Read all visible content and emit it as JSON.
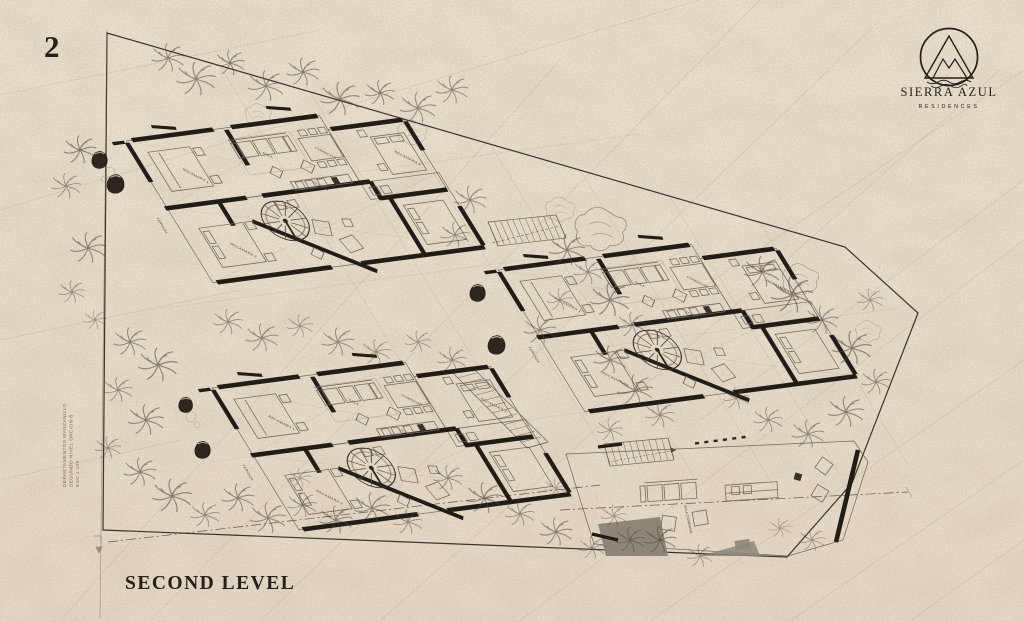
{
  "sheet": {
    "number": "2",
    "level_title": "SECOND LEVEL"
  },
  "logo": {
    "name": "SIERRA AZUL",
    "subtitle": "RESIDENCES"
  },
  "margin_note": {
    "line1": "DEPARTAMENTOS MANZANILLO",
    "line2": "SEGUNDO NIVEL OPCION B",
    "line3": "ESC 1:100"
  },
  "plan": {
    "room_labels": {
      "bedroom1": "RECAMARA 1",
      "bedroom2": "RECAMARA 2",
      "bedroom3": "RECAMARA 3",
      "living": "SALA",
      "dining": "COMEDOR",
      "kitchen": "COCINA",
      "terrace": "TERRAZA",
      "terrace_living": "SALA COMEDOR"
    },
    "colors": {
      "paper": "#e8dfcd",
      "ink": "#26211a",
      "wall": "#211c16",
      "gray_fill": "#8d8679",
      "crease": "#6b5f4c"
    }
  }
}
